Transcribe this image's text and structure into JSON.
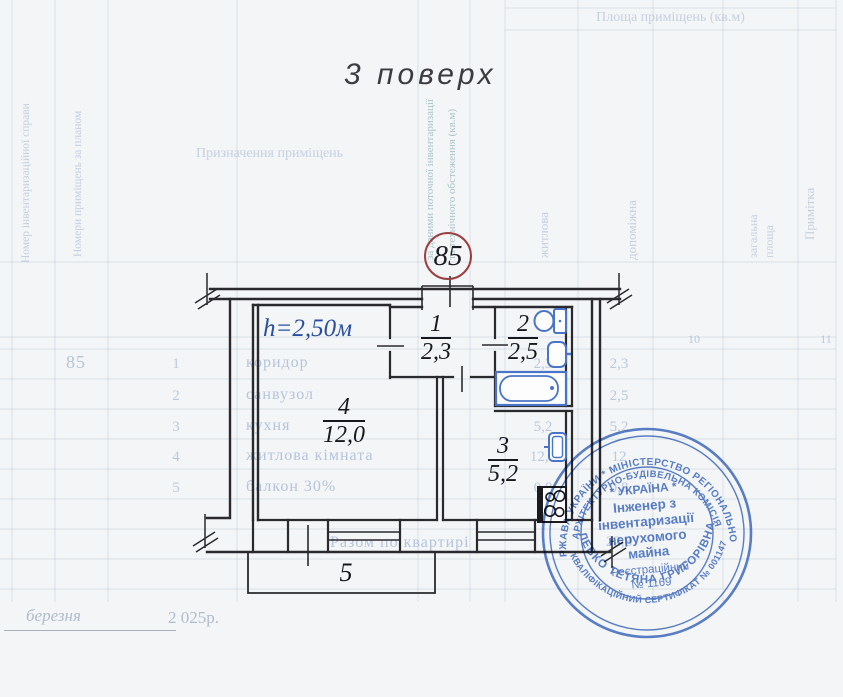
{
  "page": {
    "title": "3 поверх",
    "footer": {
      "month_line": "березня",
      "year_line": "2 025р."
    }
  },
  "floor_plan": {
    "apartment_number": "85",
    "ceiling_height": "h=2,50м",
    "rooms": [
      {
        "number": "1",
        "area": "2,3"
      },
      {
        "number": "2",
        "area": "2,5"
      },
      {
        "number": "3",
        "area": "5,2"
      },
      {
        "number": "4",
        "area": "12,0"
      },
      {
        "number": "5",
        "area": ""
      }
    ]
  },
  "background_table": {
    "area_header": "Площа приміщень (кв.м)",
    "col_inventory_number": "Номер інвентаризаційної справи",
    "col_room_numbers": "Номери приміщень за планом",
    "col_purpose": "Призначення приміщень",
    "col_current_1": "за даними поточної інвентаризації",
    "col_current_2": "та технічного обстеження (кв.м)",
    "col_living": "житлова",
    "col_auxiliary": "допоміжна",
    "col_total_1": "загальна",
    "col_total_2": "площа",
    "col_note": "Примітка",
    "col_no_10": "10",
    "col_no_11": "11",
    "apartment_number": "85",
    "rows": [
      {
        "no": "1",
        "name": "коридор",
        "area1": "2,3",
        "area2": "2,3"
      },
      {
        "no": "2",
        "name": "санвузол",
        "area1": "2,5",
        "area2": "2,5"
      },
      {
        "no": "3",
        "name": "кухня",
        "area1": "5,2",
        "area2": "5,2"
      },
      {
        "no": "4",
        "name": "житлова кімната",
        "area1": "12,0",
        "area2": "12"
      },
      {
        "no": "5",
        "name": "балкон 30%",
        "area1": "0,8",
        "area2": "0,8"
      }
    ],
    "total_label": "Разом по квартирі",
    "total_value": "22,8"
  },
  "stamp": {
    "arc_top_outer": "ДЕРЖАВА УКРАЇНИ * МІНІСТЕРСТВО РЕГІОНАЛЬНОГО",
    "arc_top_inner": "АРХІТЕКТУРНО-БУДІВЕЛЬНА КОМІСІЯ",
    "arc_bottom_outer": "КВАЛІФІКАЦІЙНИЙ СЕРТИФІКАТ № 001147",
    "arc_bottom_inner": "ЛЕВКО ТЕТЯНА ГРИГОРІВНА",
    "center_line_1": "* УКРАЇНА *",
    "center_line_2": "Інженер з",
    "center_line_3": "інвентаризації",
    "center_line_4": "нерухомого",
    "center_line_5": "майна",
    "center_line_6": "Реєстраційний",
    "center_line_7": "№ 1169"
  },
  "colors": {
    "stamp_blue": "#3f6cc2",
    "fixture_blue": "#4a74c8",
    "apartment_circle_red": "#9a4040",
    "height_label_blue": "#2b4fa0",
    "paper": "#f3f5f6"
  }
}
